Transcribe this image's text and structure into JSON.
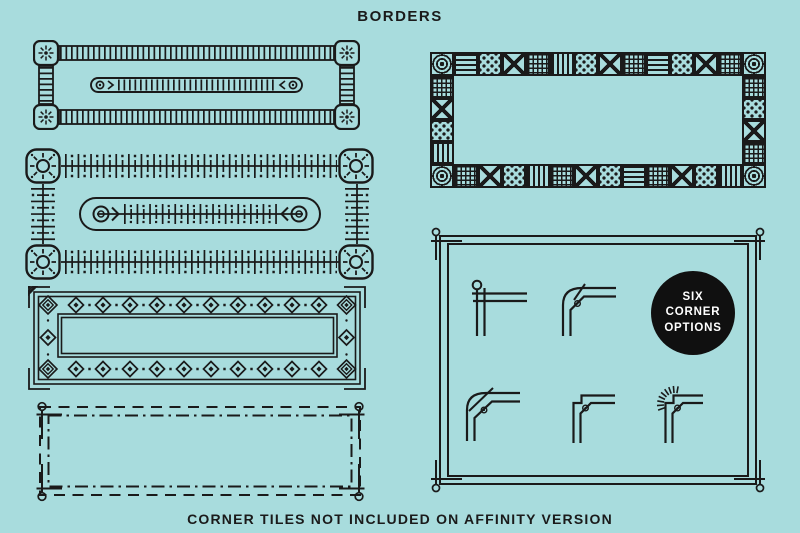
{
  "page": {
    "title": "BORDERS",
    "footer_note": "CORNER TILES NOT INCLUDED ON AFFINITY VERSION",
    "background_color": "#a8dcdd",
    "ink_color": "#1a1a1a"
  },
  "badge": {
    "line1": "SIX",
    "line2": "CORNER",
    "line3": "OPTIONS",
    "background_color": "#101010",
    "text_color": "#ffffff"
  },
  "figures": {
    "border_railroad": "railroad-track-border",
    "border_sunburst": "sunburst-corner-border",
    "border_diamond": "diamond-motif-border",
    "border_dashed": "dashed-line-border",
    "border_tiles": "patchwork-tile-border",
    "corner_panel": "corner-options-panel",
    "tile_patterns": [
      "bullseye",
      "horizontal-stripes",
      "polka-dots",
      "cross-x",
      "fine-grid",
      "vertical-stripes"
    ],
    "corner_options": [
      "circle-cross-corner",
      "rounded-chamfer-corner",
      "curved-spur-corner",
      "stepped-chamfer-corner",
      "sunray-chamfer-corner"
    ]
  }
}
